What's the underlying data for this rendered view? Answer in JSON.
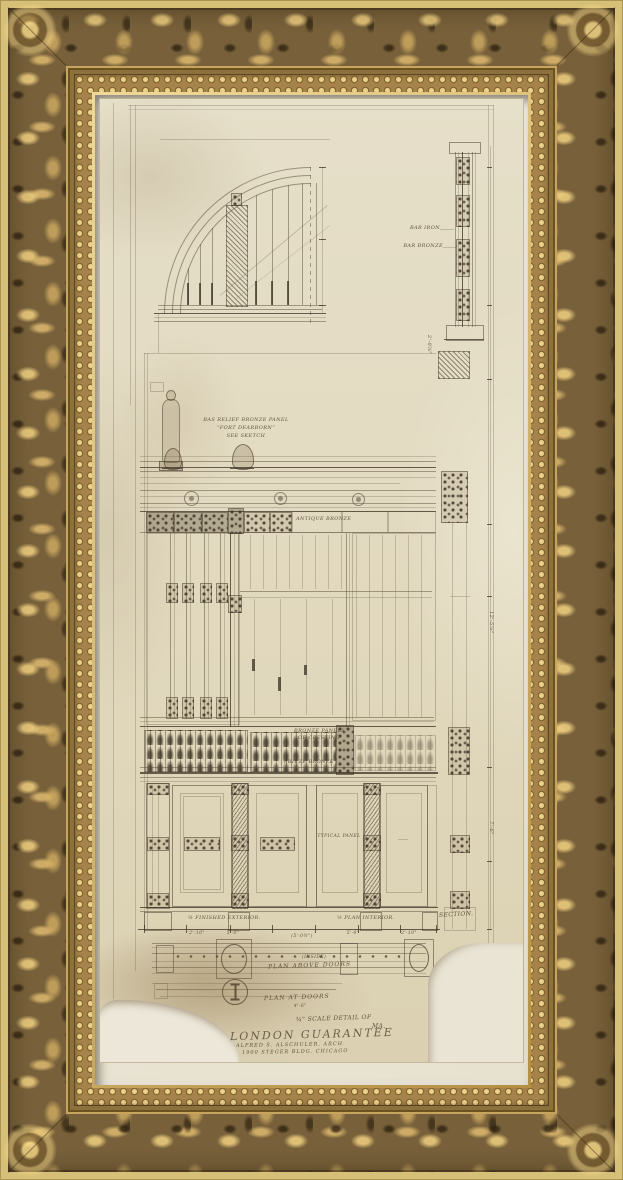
{
  "artwork": {
    "frame_gold_color": "#a5834a",
    "frame_outer_border_color": "#d6c078",
    "mat_color": "#ece7d8",
    "paper_color": "#e2dabf",
    "ink_color": "#5c4f3d"
  },
  "labels": {
    "bar_iron": "BAR IRON",
    "bar_bronze": "BAR BRONZE",
    "bas_relief_line1": "BAS RELIEF BRONZE PANEL",
    "bas_relief_line2": "“FORT DEARBORN”",
    "bas_relief_line3": "SEE SKETCH",
    "antique_bronze": "ANTIQUE BRONZE",
    "bronze_panels_line1": "BRONZE PANELS",
    "bronze_panels_line2": "OF CRESTING",
    "frieze_bronze": "FRIEZE BRONZE",
    "typical_panel": "TYPICAL PANEL",
    "dim_2_0": "2'-0⅞\"",
    "dim_12_5": "12'-5⅞\"",
    "dim_7_6": "7'-6\"",
    "half_finished_exterior": "½ FINISHED EXTERIOR.",
    "half_plan_interior": "½ PLAN INTERIOR.",
    "section": "SECTION.",
    "dims_row": [
      "2'-10\"",
      "5'-0\"",
      "(5'-0½\")",
      "5'-0\"",
      "2'-10\""
    ],
    "inside": "(INSIDE)",
    "plan_above_doors": "PLAN ABOVE DOORS",
    "plan_at_doors": "PLAN AT DOORS",
    "dim_4_6": "4'-6\""
  },
  "title_block": {
    "line1": "¾\" SCALE DETAIL OF",
    "line2": "MA.",
    "line3": "LONDON GUARANTEE",
    "line4": "ALFRED S. ALSCHULER, ARCH.",
    "line5": "1900 STEGER BLDG. CHICAGO"
  }
}
